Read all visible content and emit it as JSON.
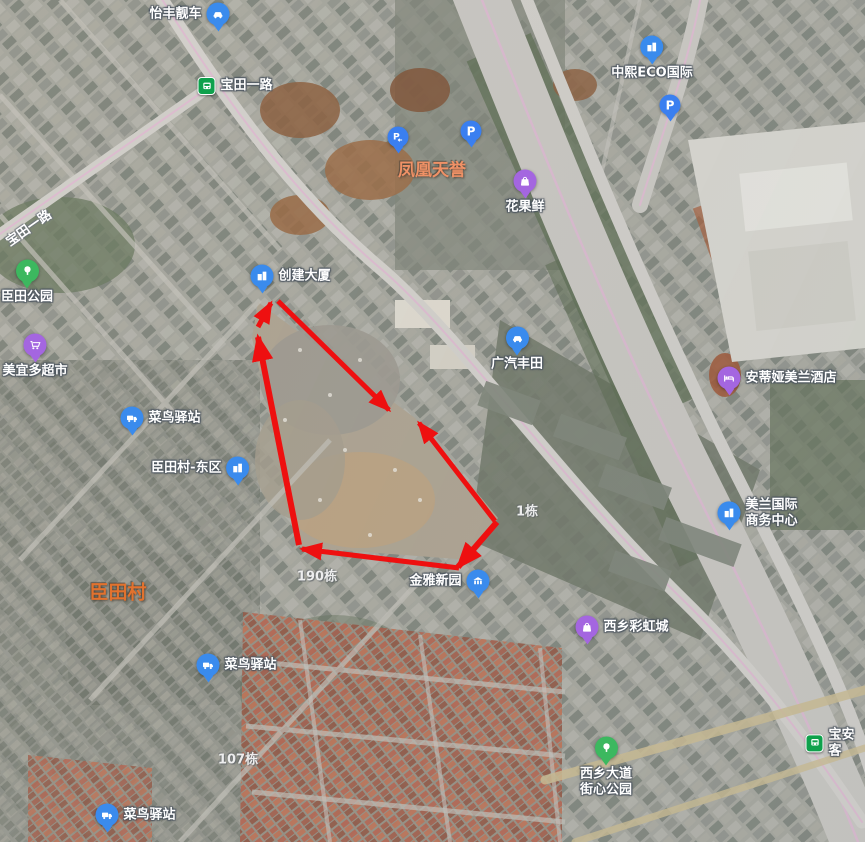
{
  "map": {
    "width": 865,
    "height": 842,
    "colors": {
      "arrow": "#ee1010",
      "pin_blue": "#3a8bed",
      "pin_purple": "#a466e0",
      "pin_green": "#3cb85f",
      "pin_parking": "#3a7ff0",
      "transit_green": "#0fa14c",
      "area_orange_light": "#ef9166",
      "area_orange": "#e2722e"
    },
    "pois": [
      {
        "label": "怡丰靓车",
        "icon": "car",
        "color": "blue",
        "x": 218,
        "y": 14,
        "labelPos": "left"
      },
      {
        "label": "宝田一路",
        "icon": "transit",
        "color": "transit",
        "x": 207,
        "y": 86,
        "labelPos": "right"
      },
      {
        "label": "中熙ECO国际",
        "icon": "building",
        "color": "blue",
        "x": 652,
        "y": 47,
        "labelPos": "below"
      },
      {
        "label": "",
        "icon": "parking",
        "color": "parking",
        "x": 670,
        "y": 105,
        "labelPos": "none"
      },
      {
        "label": "",
        "icon": "parking-entrance",
        "color": "parking",
        "x": 398,
        "y": 137,
        "labelPos": "none"
      },
      {
        "label": "",
        "icon": "parking",
        "color": "parking",
        "x": 471,
        "y": 131,
        "labelPos": "none"
      },
      {
        "label": "花果鲜",
        "icon": "bag",
        "color": "purple",
        "x": 525,
        "y": 181,
        "labelPos": "below"
      },
      {
        "label": "创建大厦",
        "icon": "building",
        "color": "blue",
        "x": 262,
        "y": 276,
        "labelPos": "right"
      },
      {
        "label": "广汽丰田",
        "icon": "car",
        "color": "blue",
        "x": 517,
        "y": 338,
        "labelPos": "below"
      },
      {
        "label": "安蒂娅美兰酒店",
        "icon": "hotel",
        "color": "purple",
        "x": 729,
        "y": 378,
        "labelPos": "right"
      },
      {
        "label": "美兰国际\n商务中心",
        "icon": "building",
        "color": "blue",
        "x": 729,
        "y": 513,
        "labelPos": "right"
      },
      {
        "label": "臣田公园",
        "icon": "tree",
        "color": "green",
        "x": 27,
        "y": 271,
        "labelPos": "below"
      },
      {
        "label": "美宜多超市",
        "icon": "cart",
        "color": "purple",
        "x": 35,
        "y": 345,
        "labelPos": "below"
      },
      {
        "label": "菜鸟驿站",
        "icon": "truck",
        "color": "blue",
        "x": 132,
        "y": 418,
        "labelPos": "right"
      },
      {
        "label": "臣田村-东区",
        "icon": "building",
        "color": "blue",
        "x": 238,
        "y": 468,
        "labelPos": "left"
      },
      {
        "label": "菜鸟驿站",
        "icon": "truck",
        "color": "blue",
        "x": 208,
        "y": 665,
        "labelPos": "right"
      },
      {
        "label": "金雅新园",
        "icon": "bank",
        "color": "blue",
        "x": 478,
        "y": 581,
        "labelPos": "left"
      },
      {
        "label": "西乡彩虹城",
        "icon": "bag",
        "color": "purple",
        "x": 587,
        "y": 627,
        "labelPos": "right"
      },
      {
        "label": "西乡大道\n街心公园",
        "icon": "tree",
        "color": "green",
        "x": 606,
        "y": 748,
        "labelPos": "below"
      },
      {
        "label": "宝安客",
        "icon": "transit",
        "color": "transit",
        "x": 815,
        "y": 743,
        "labelPos": "right"
      },
      {
        "label": "菜鸟驿站",
        "icon": "truck",
        "color": "blue",
        "x": 107,
        "y": 815,
        "labelPos": "right"
      }
    ],
    "area_labels": [
      {
        "text": "凤凰天誉",
        "x": 432,
        "y": 168,
        "size": 17,
        "color_key": "area_orange_light"
      },
      {
        "text": "臣田村",
        "x": 118,
        "y": 591,
        "size": 19,
        "color_key": "area_orange"
      }
    ],
    "building_labels": [
      {
        "text": "190栋",
        "x": 317,
        "y": 575
      },
      {
        "text": "107栋",
        "x": 238,
        "y": 758
      },
      {
        "text": "1栋",
        "x": 527,
        "y": 510
      }
    ],
    "road_labels": [
      {
        "text": "宝田一路",
        "x": 28,
        "y": 227,
        "rotate": -35
      }
    ],
    "arrows": [
      {
        "x1": 278,
        "y1": 301,
        "x2": 389,
        "y2": 410,
        "w": 5
      },
      {
        "x1": 258,
        "y1": 327,
        "x2": 271,
        "y2": 303,
        "w": 5
      },
      {
        "x1": 299,
        "y1": 545,
        "x2": 258,
        "y2": 337,
        "w": 6
      },
      {
        "x1": 459,
        "y1": 568,
        "x2": 302,
        "y2": 549,
        "w": 5
      },
      {
        "x1": 495,
        "y1": 521,
        "x2": 419,
        "y2": 423,
        "w": 5
      },
      {
        "x1": 497,
        "y1": 522,
        "x2": 458,
        "y2": 567,
        "w": 6
      }
    ]
  }
}
